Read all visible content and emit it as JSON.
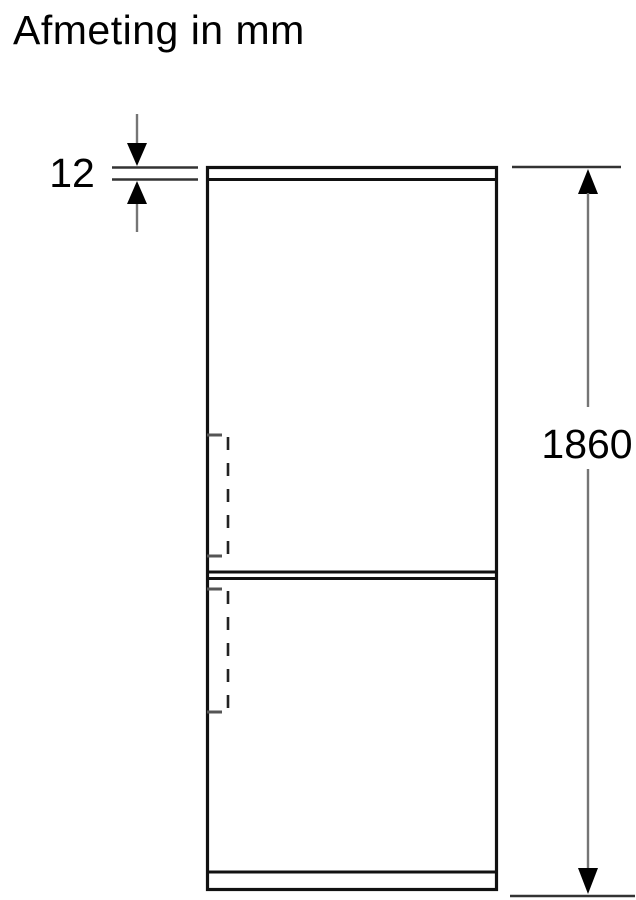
{
  "title": "Afmeting in mm",
  "dimensions": {
    "top_panel_thickness": {
      "label": "12"
    },
    "overall_height": {
      "label": "1860"
    }
  },
  "colors": {
    "background": "#ffffff",
    "text": "#000000",
    "outline": "#111111",
    "extension_line": "#333333",
    "dimension_line": "#757575",
    "arrowhead": "#000000",
    "dashed_line": "#222222",
    "tick": "#555555"
  }
}
